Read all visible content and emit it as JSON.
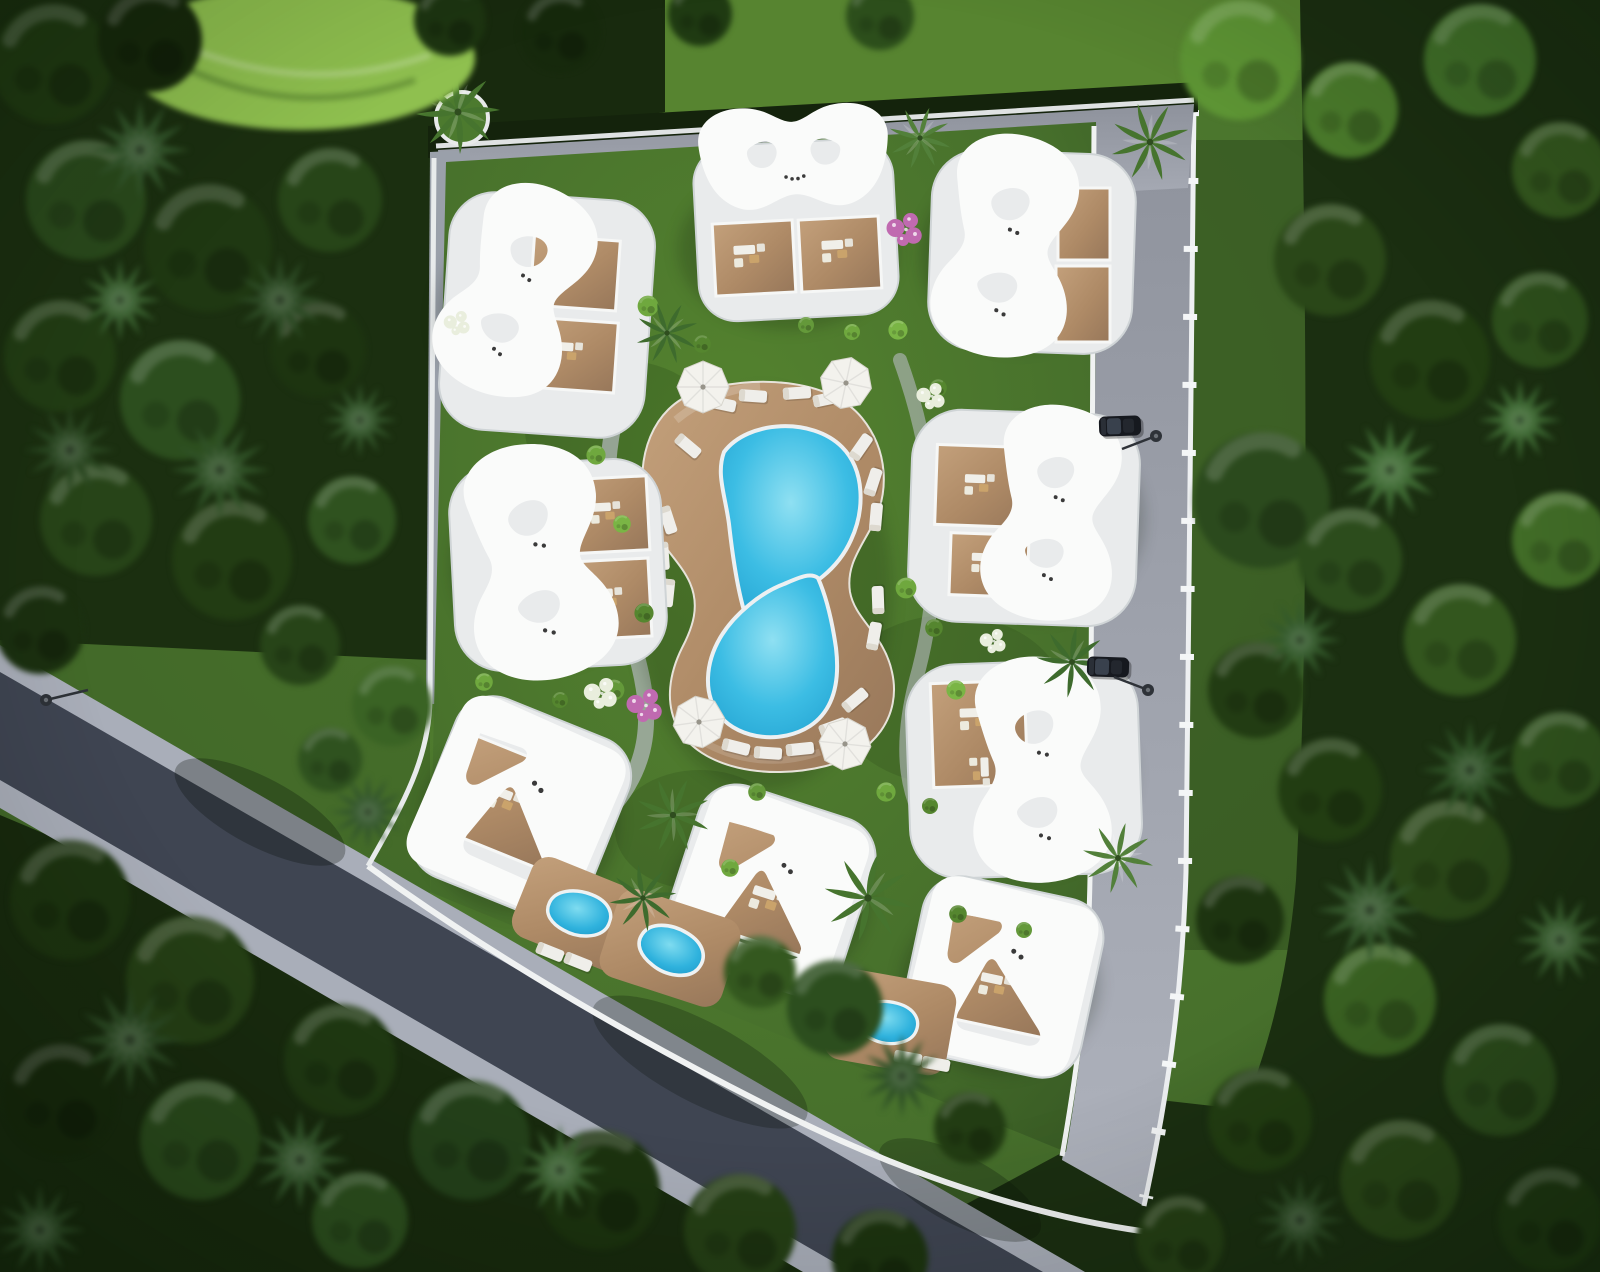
{
  "scene": {
    "type": "aerial-3d-architectural-render",
    "view": "top-down bird's-eye view, daytime",
    "description": "Top-down aerial 3D architectural rendering of a boutique villa resort: nine white villas with sculptural curved roofs (hourglass, bow-tie and notched-square shapes) arranged around a central figure-eight lagoon pool with a timber sun deck, loungers and white parasols, all inside a walled landscaped plot with lawns, shrubs, flower beds and palm trees. The plot is framed by dense mixed forest, an asphalt road with sidewalks runs diagonally past the lower-left corner, and a paved access road with parked cars and street lamps runs along the top and right edges.",
    "counts": {
      "villas": 9,
      "hourglass_roofs": 5,
      "bowtie_roofs": 1,
      "square_roofs": 3,
      "main_pool_lagoons": 2,
      "plunge_pools": 3,
      "parasols": 4,
      "sun_loungers": 24,
      "cars": 2,
      "street_lamps": 3,
      "palm_trees": 9
    },
    "landscape": {
      "surroundings": "dense mixed forest of round-canopy trees and conifers",
      "roads": [
        "diagonal asphalt road with light sidewalks at lower left",
        "paved access road along right edge with white curb",
        "paved perimeter drive along top and left of the compound"
      ],
      "accents": [
        "bright weeping tree at upper left",
        "pink and white flower beds",
        "round clipped shrubs"
      ]
    }
  },
  "colors": {
    "lawn": "#4a7030",
    "lawn_bright": "#5e8c38",
    "lawn_shade": "#2f4d1f",
    "forest_dark": "#16260e",
    "forest_mid": "#27431a",
    "forest_light": "#3f6a28",
    "foliage_bright": "#8fc04f",
    "asphalt": "#3f4552",
    "sidewalk": "#a9aeb9",
    "paving": "#9fa3ad",
    "curb_white": "#eef0f2",
    "villa_white": "#fafbfa",
    "villa_plinth": "#e9ebec",
    "deck_wood": "#b08a66",
    "terrace_wood": "#a58866",
    "pool_water": "#3cbde4",
    "umbrella_white": "#f3f2ed",
    "lounger_white": "#efeeea",
    "car_black": "#16191f",
    "flower_pink": "#c06ab0",
    "flower_white": "#e9eedd",
    "palm_green": "#46742e",
    "shrub_green": "#6fa83e",
    "lamp_gray": "#2e3238"
  }
}
